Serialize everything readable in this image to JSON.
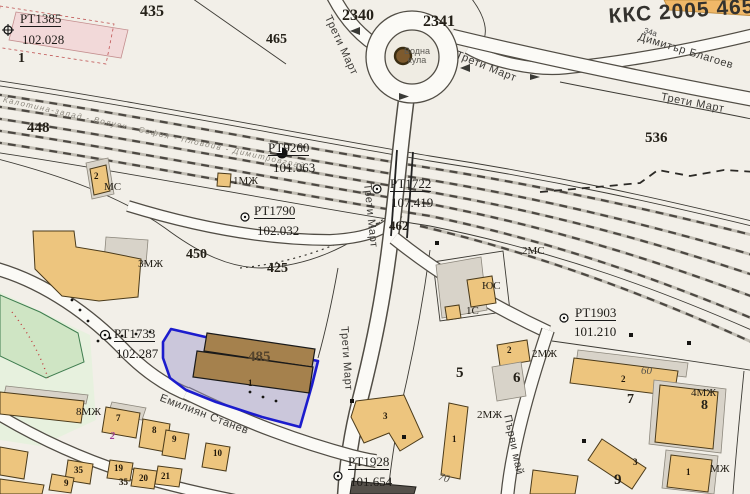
{
  "map_sheet": {
    "code": "ККС 2005 4657"
  },
  "streets": {
    "treti_mart": "Трети Март",
    "dimitar_blagoev": "Димитър Благоев",
    "emilian_stanev": "Емилиян Станев",
    "parvi_mai": "Първи май"
  },
  "railway": {
    "line_label": "Калотина-запад - Волуяк - София - Пловдив - Димитровград"
  },
  "landmarks": {
    "water_tower_line1": "Водна",
    "water_tower_line2": "кула",
    "house_number": "34а"
  },
  "survey_points": {
    "pt1385": {
      "name": "РТ1385",
      "elevation": "102.028"
    },
    "pt9260": {
      "name": "РТ9260",
      "elevation": "101.063"
    },
    "pt1722": {
      "name": "РТ1722",
      "elevation": "107.419"
    },
    "pt1790": {
      "name": "РТ1790",
      "elevation": "102.032"
    },
    "pt1733": {
      "name": "РТ1733",
      "elevation": "102.287"
    },
    "pt1903": {
      "name": "РТ1903",
      "elevation": "101.210"
    },
    "pt1928": {
      "name": "РТ1928",
      "elevation": "101.654"
    }
  },
  "parcel_numbers": {
    "p1": "1",
    "p435": "435",
    "p465": "465",
    "p448": "448",
    "p450": "450",
    "p425": "425",
    "p462": "462",
    "p485": "485",
    "p536": "536",
    "p2340": "2340",
    "p2341": "2341",
    "p60": "60",
    "p70": "70"
  },
  "block_numbers": {
    "b5": "5",
    "b6": "6",
    "b7": "7",
    "b8": "8",
    "b9": "9"
  },
  "building_types": {
    "t1mzh": "1МЖ",
    "t2ms": "2МС",
    "t3mzh": "3МЖ",
    "t2mzh_a": "2МЖ",
    "t2mzh_b": "2МЖ",
    "t4mzh": "4МЖ",
    "t8mzh": "8МЖ",
    "tms": "МС",
    "t1s": "1С",
    "tyus": "ЮС",
    "tmzh": "МЖ"
  },
  "building_numbers": {
    "brown_1": "1",
    "ms_2": "2",
    "small_2": "2",
    "big_2": "2",
    "tall_1": "1",
    "br_1": "1",
    "l_3": "3",
    "diag_3": "3",
    "c7": "7",
    "c8": "8",
    "c9": "9",
    "c10": "10",
    "c19": "19",
    "c20": "20",
    "c21": "21",
    "c35a": "35",
    "c35b": "35",
    "c9b": "9",
    "magenta_2": "2"
  },
  "colors": {
    "parcel_highlight": "#1c1ccd",
    "building_fill": "#edc57e",
    "selected_fill": "#9c96cc"
  }
}
